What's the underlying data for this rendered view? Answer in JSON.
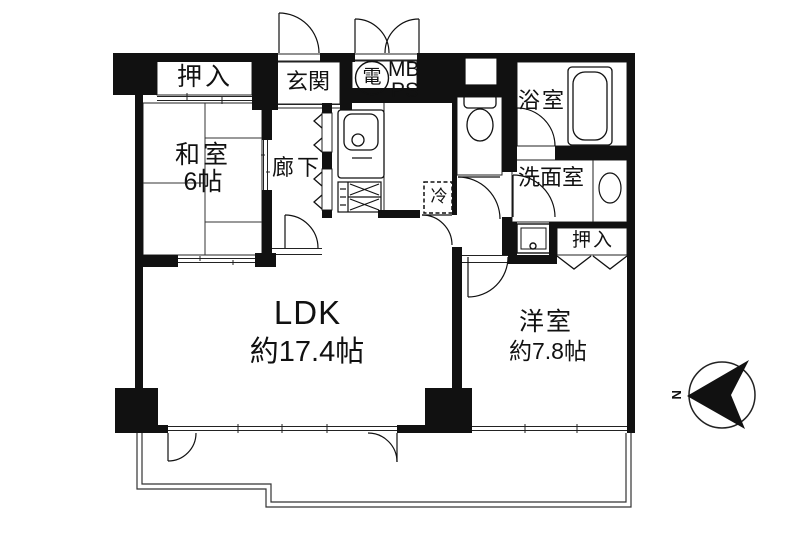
{
  "floorplan": {
    "rooms": {
      "closet_top": {
        "label": "押入"
      },
      "entrance": {
        "label": "玄関"
      },
      "utility": {
        "electric": "電",
        "meter_box": "MB",
        "pipe_shaft": "PS"
      },
      "bathroom": {
        "label": "浴室"
      },
      "washroom": {
        "label": "洗面室"
      },
      "refrigerator": {
        "label": "冷"
      },
      "corridor": {
        "label": "廊下"
      },
      "japanese_room": {
        "label": "和室",
        "size": "6帖"
      },
      "closet_side": {
        "label": "押入"
      },
      "ldk": {
        "label": "LDK",
        "size": "約17.4帖"
      },
      "western_room": {
        "label": "洋室",
        "size": "約7.8帖"
      }
    },
    "compass": {
      "north": "N"
    },
    "colors": {
      "wall": "#111111",
      "line": "#333333",
      "background": "#ffffff"
    },
    "icons": [
      "kitchen-sink-icon",
      "stove-icon",
      "toilet-icon",
      "bathtub-icon",
      "wash-basin-icon",
      "washing-machine-icon",
      "electric-meter-icon",
      "compass-icon"
    ]
  }
}
